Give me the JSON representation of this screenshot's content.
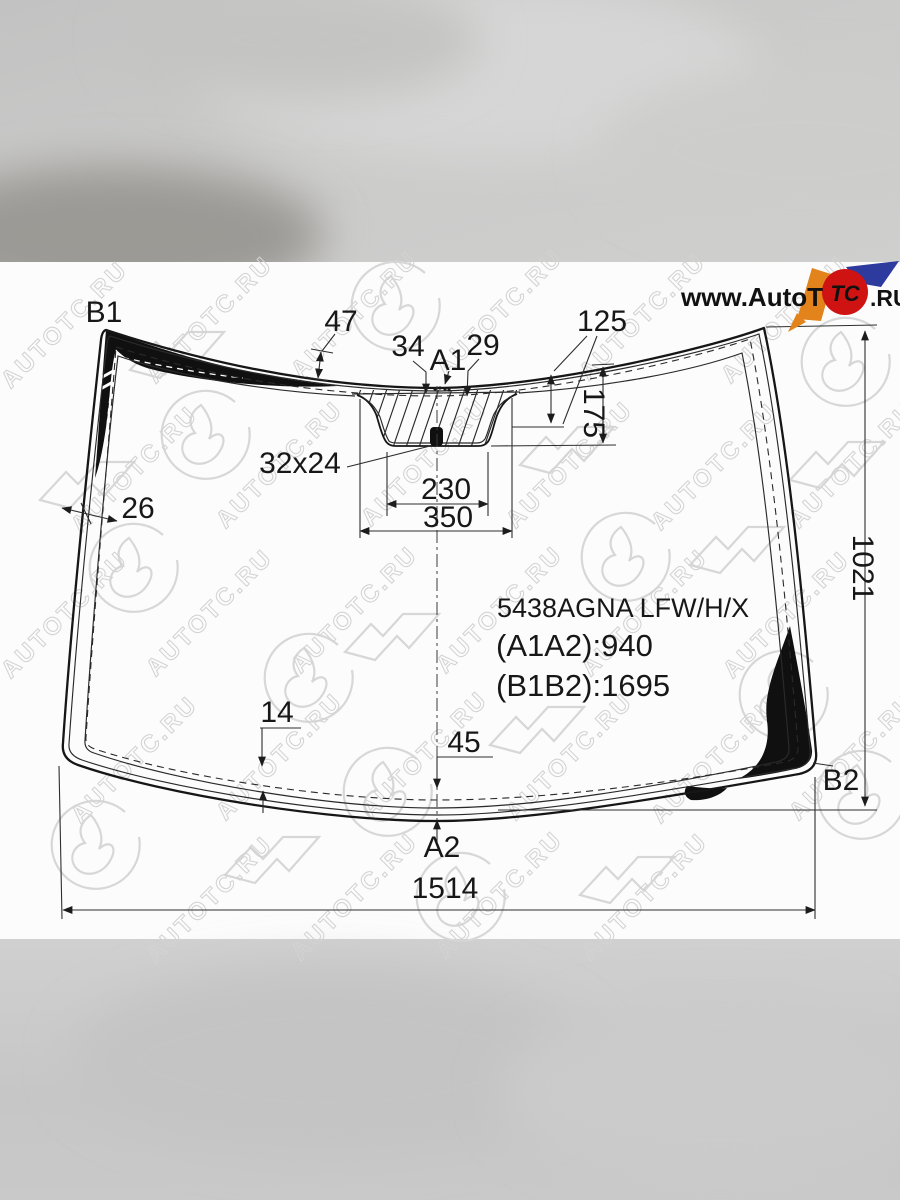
{
  "brand": {
    "watermark_text": "AUTOTC.RU",
    "logo_prefix": "www.AutoT",
    "logo_circle": "TC",
    "logo_suffix": ".RU",
    "colors": {
      "red": "#cf1212",
      "orange": "#e2831c",
      "blue": "#2d3a9e",
      "white": "#ffffff"
    }
  },
  "part": {
    "code": "5438AGNA LFW/H/X",
    "length_a": "(A1A2):940",
    "length_b": "(B1B2):1695"
  },
  "points": {
    "a1": "A1",
    "a2": "A2",
    "b1": "B1",
    "b2": "B2"
  },
  "dims": {
    "band_top": "47",
    "offset_left": "34",
    "offset_right": "29",
    "to_sensor_top": "125",
    "to_mount_bottom": "175",
    "sensor_size": "32x24",
    "mount_inner_width": "230",
    "mount_outer_width": "350",
    "band_left": "26",
    "height": "1021",
    "band_bottom_side": "14",
    "band_bottom_center": "45",
    "width": "1514"
  }
}
